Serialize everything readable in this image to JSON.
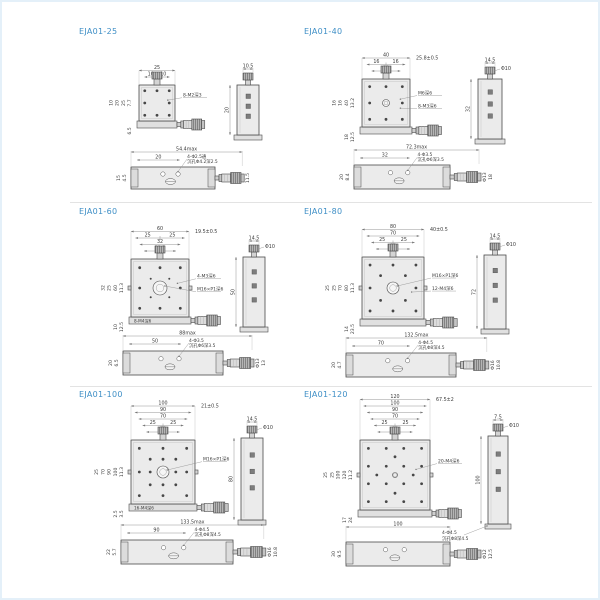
{
  "page": {
    "accent_color": "#3f8fc6",
    "divider_color": "#e3e3e3",
    "frame_color": "#e4f0f9"
  },
  "panels": [
    {
      "title": "EJA01-25",
      "top": {
        "rows": [
          [
            "25"
          ],
          [
            "10",
            "10"
          ]
        ],
        "right_top": "",
        "left": [
          "7.7",
          "25",
          "20",
          "10"
        ],
        "left_bottom": [
          "6.5"
        ],
        "notes": [
          "8-M2深3"
        ],
        "base_note": ""
      },
      "side": {
        "width": "10.5",
        "dia": "",
        "height": "20",
        "note1": "",
        "note2": ""
      },
      "bottom": {
        "max": "54.4max",
        "inner": "20",
        "note1": "4-Φ2.5通",
        "note2": "沉孔Φ4.2深2.5",
        "left": [
          "4.5",
          "15"
        ],
        "right": [
          "11.5"
        ]
      }
    },
    {
      "title": "EJA01-40",
      "top": {
        "rows": [
          [
            "40"
          ],
          [
            "16",
            "16"
          ],
          [
            "28"
          ]
        ],
        "right_top": "25.8±0.5",
        "left": [
          "13.2",
          "40",
          "16",
          "16"
        ],
        "left_bottom": [
          "12.5",
          "18"
        ],
        "notes": [
          "M6深6",
          "8-M3深6"
        ],
        "base_note": ""
      },
      "side": {
        "width": "14.5",
        "dia": "Φ10",
        "height": "32",
        "note1": "",
        "note2": ""
      },
      "bottom": {
        "max": "72.3max",
        "inner": "32",
        "note1": "4-Φ3.5",
        "note2": "沉孔Φ6深3.5",
        "left": [
          "8.4",
          "20"
        ],
        "right": [
          "Φ13",
          "18"
        ]
      }
    },
    {
      "title": "EJA01-60",
      "top": {
        "rows": [
          [
            "60"
          ],
          [
            "25",
            "25"
          ],
          [
            "32"
          ],
          [
            "32.5"
          ]
        ],
        "right_top": "19.5±0.5",
        "left": [
          "11.3",
          "60",
          "25",
          "32"
        ],
        "left_bottom": [
          "12.5",
          "10"
        ],
        "notes": [
          "4-M3深6",
          "M16×P1深6"
        ],
        "base_note": "8-M4深6"
      },
      "side": {
        "width": "14.5",
        "dia": "Φ10",
        "height": "50",
        "note1": "",
        "note2": ""
      },
      "bottom": {
        "max": "88max",
        "inner": "50",
        "note1": "4-Φ3.5",
        "note2": "沉孔Φ6深3.5",
        "left": [
          "6.5",
          "20"
        ],
        "right": [
          "Φ13",
          "13"
        ]
      }
    },
    {
      "title": "EJA01-80",
      "top": {
        "rows": [
          [
            "80"
          ],
          [
            "70"
          ],
          [
            "25",
            "25"
          ],
          [
            "55"
          ]
        ],
        "right_top": "40±0.5",
        "left": [
          "11.3",
          "80",
          "70",
          "25",
          "25"
        ],
        "left_bottom": [
          "23.5",
          "14"
        ],
        "notes": [
          "M16×P1深6",
          "12-M4深6"
        ],
        "base_note": ""
      },
      "side": {
        "width": "14.5",
        "dia": "Φ10",
        "height": "72",
        "note1": "",
        "note2": ""
      },
      "bottom": {
        "max": "132.5max",
        "inner": "70",
        "note1": "4-Φ4.5",
        "note2": "沉孔Φ8深4.5",
        "left": [
          "4.7",
          "20"
        ],
        "right": [
          "Φ16",
          "10.8"
        ]
      }
    },
    {
      "title": "EJA01-100",
      "top": {
        "rows": [
          [
            "100"
          ],
          [
            "90"
          ],
          [
            "70"
          ],
          [
            "25",
            "25"
          ],
          [
            "75"
          ]
        ],
        "right_top": "21±0.5",
        "left": [
          "11.3",
          "100",
          "90",
          "70",
          "25"
        ],
        "left_bottom": [
          "3.5",
          "2.5"
        ],
        "notes": [
          "M16×P1深6"
        ],
        "base_note": "16-M4深6"
      },
      "side": {
        "width": "14.5",
        "dia": "Φ10",
        "height": "80",
        "note1": "",
        "note2": ""
      },
      "bottom": {
        "max": "133.5max",
        "inner": "90",
        "note1": "4-Φ4.5",
        "note2": "沉孔Φ8深4.5",
        "left": [
          "5.7",
          "22"
        ],
        "right": [
          "Φ16",
          "10.8"
        ]
      }
    },
    {
      "title": "EJA01-120",
      "top": {
        "rows": [
          [
            "120"
          ],
          [
            "100"
          ],
          [
            "90"
          ],
          [
            "70"
          ],
          [
            "25",
            "25"
          ],
          [
            "55"
          ]
        ],
        "right_top": "67.5±2",
        "left": [
          "11.2",
          "120",
          "100",
          "25",
          "25"
        ],
        "left_bottom": [
          "24",
          "17"
        ],
        "notes": [
          "20-M4深6"
        ],
        "base_note": ""
      },
      "side": {
        "width": "7.5",
        "dia": "Φ10",
        "height": "100",
        "note1": "4-Φ4.5",
        "note2": "沉孔Φ8深4.5"
      },
      "bottom": {
        "max": "100",
        "inner": "",
        "note1": "",
        "note2": "",
        "left": [
          "9.5",
          "30"
        ],
        "right": [
          "Φ12",
          "12.5"
        ]
      }
    }
  ]
}
